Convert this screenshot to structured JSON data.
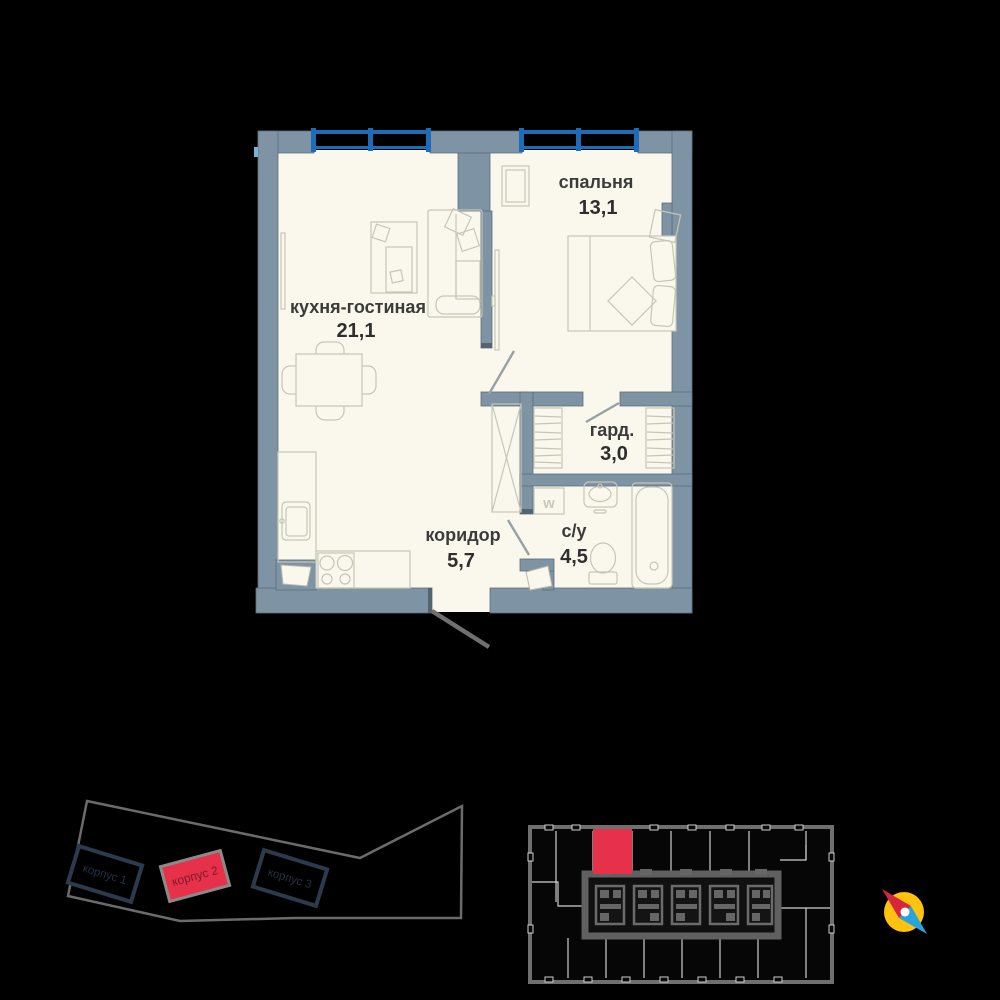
{
  "floor_plan": {
    "rooms": [
      {
        "id": "bedroom",
        "name": "спальня",
        "area": "13,1"
      },
      {
        "id": "kitchen-living",
        "name": "кухня-гостиная",
        "area": "21,1"
      },
      {
        "id": "wardrobe",
        "name": "гард.",
        "area": "3,0"
      },
      {
        "id": "corridor",
        "name": "коридор",
        "area": "5,7"
      },
      {
        "id": "bathroom",
        "name": "с/у",
        "area": "4,5"
      }
    ],
    "washer_label": "w"
  },
  "site_plan": {
    "buildings": [
      {
        "label": "корпус 1",
        "highlighted": false
      },
      {
        "label": "корпус 2",
        "highlighted": true
      },
      {
        "label": "корпус 3",
        "highlighted": false
      }
    ]
  },
  "key_plan": {
    "selected_unit_color": "#E73049"
  },
  "colors": {
    "background": "#000000",
    "wall": "#7E93A3",
    "floor": "#FAF8EC",
    "window_blue": "#1E6CB8",
    "highlight_red": "#E73049",
    "site_outline": "#6B6B6B",
    "building_outline": "#2C3B4C",
    "furniture_line": "#C6C6B6",
    "label_text": "#3B3B3B",
    "compass_yellow": "#FFC20E",
    "compass_red": "#D7263B",
    "compass_blue": "#29A3DC"
  }
}
